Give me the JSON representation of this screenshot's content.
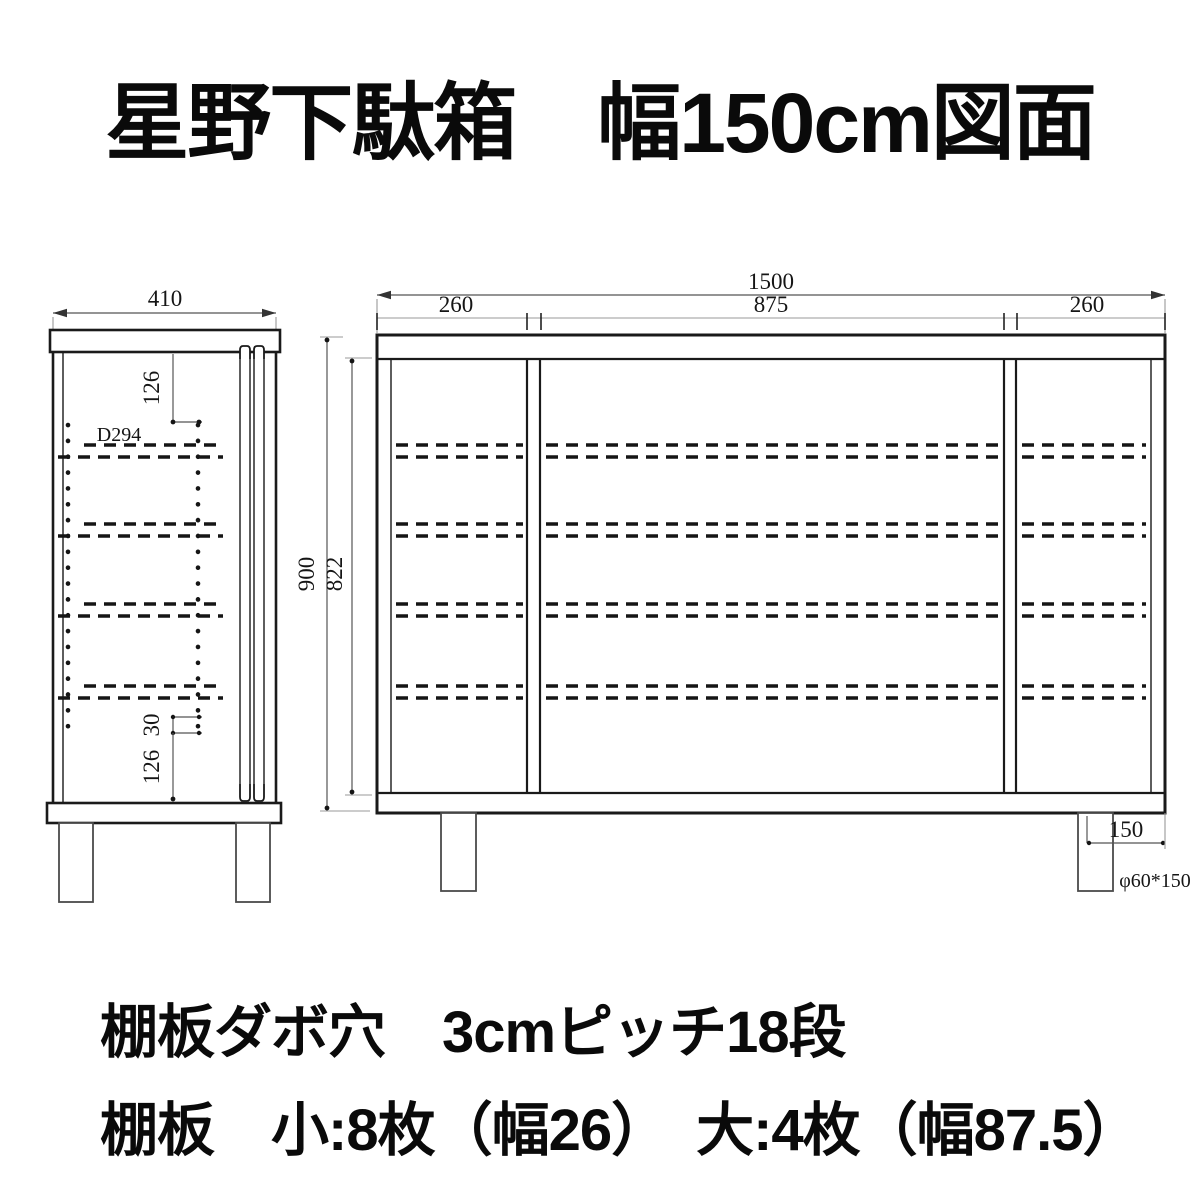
{
  "title": "星野下駄箱　幅150cm図面",
  "notes": {
    "holes": "棚板ダボ穴　3cmピッチ18段",
    "boards": "棚板　小:8枚（幅26）　大:4枚（幅87.5）"
  },
  "side_view": {
    "width_dim": "410",
    "top_offset_dim": "126",
    "depth_label": "D294",
    "hole_pitch_dim": "30",
    "bottom_offset_dim": "126"
  },
  "front_view": {
    "overall_width_dim": "1500",
    "left_section_dim": "260",
    "center_section_dim": "875",
    "right_section_dim": "260",
    "overall_height_dim": "900",
    "inner_height_dim": "822",
    "leg_height_dim": "150",
    "leg_spec": "φ60*150"
  },
  "colors": {
    "line": "#1a1a1a",
    "dim_line": "#8a8a8a",
    "background": "#ffffff"
  }
}
